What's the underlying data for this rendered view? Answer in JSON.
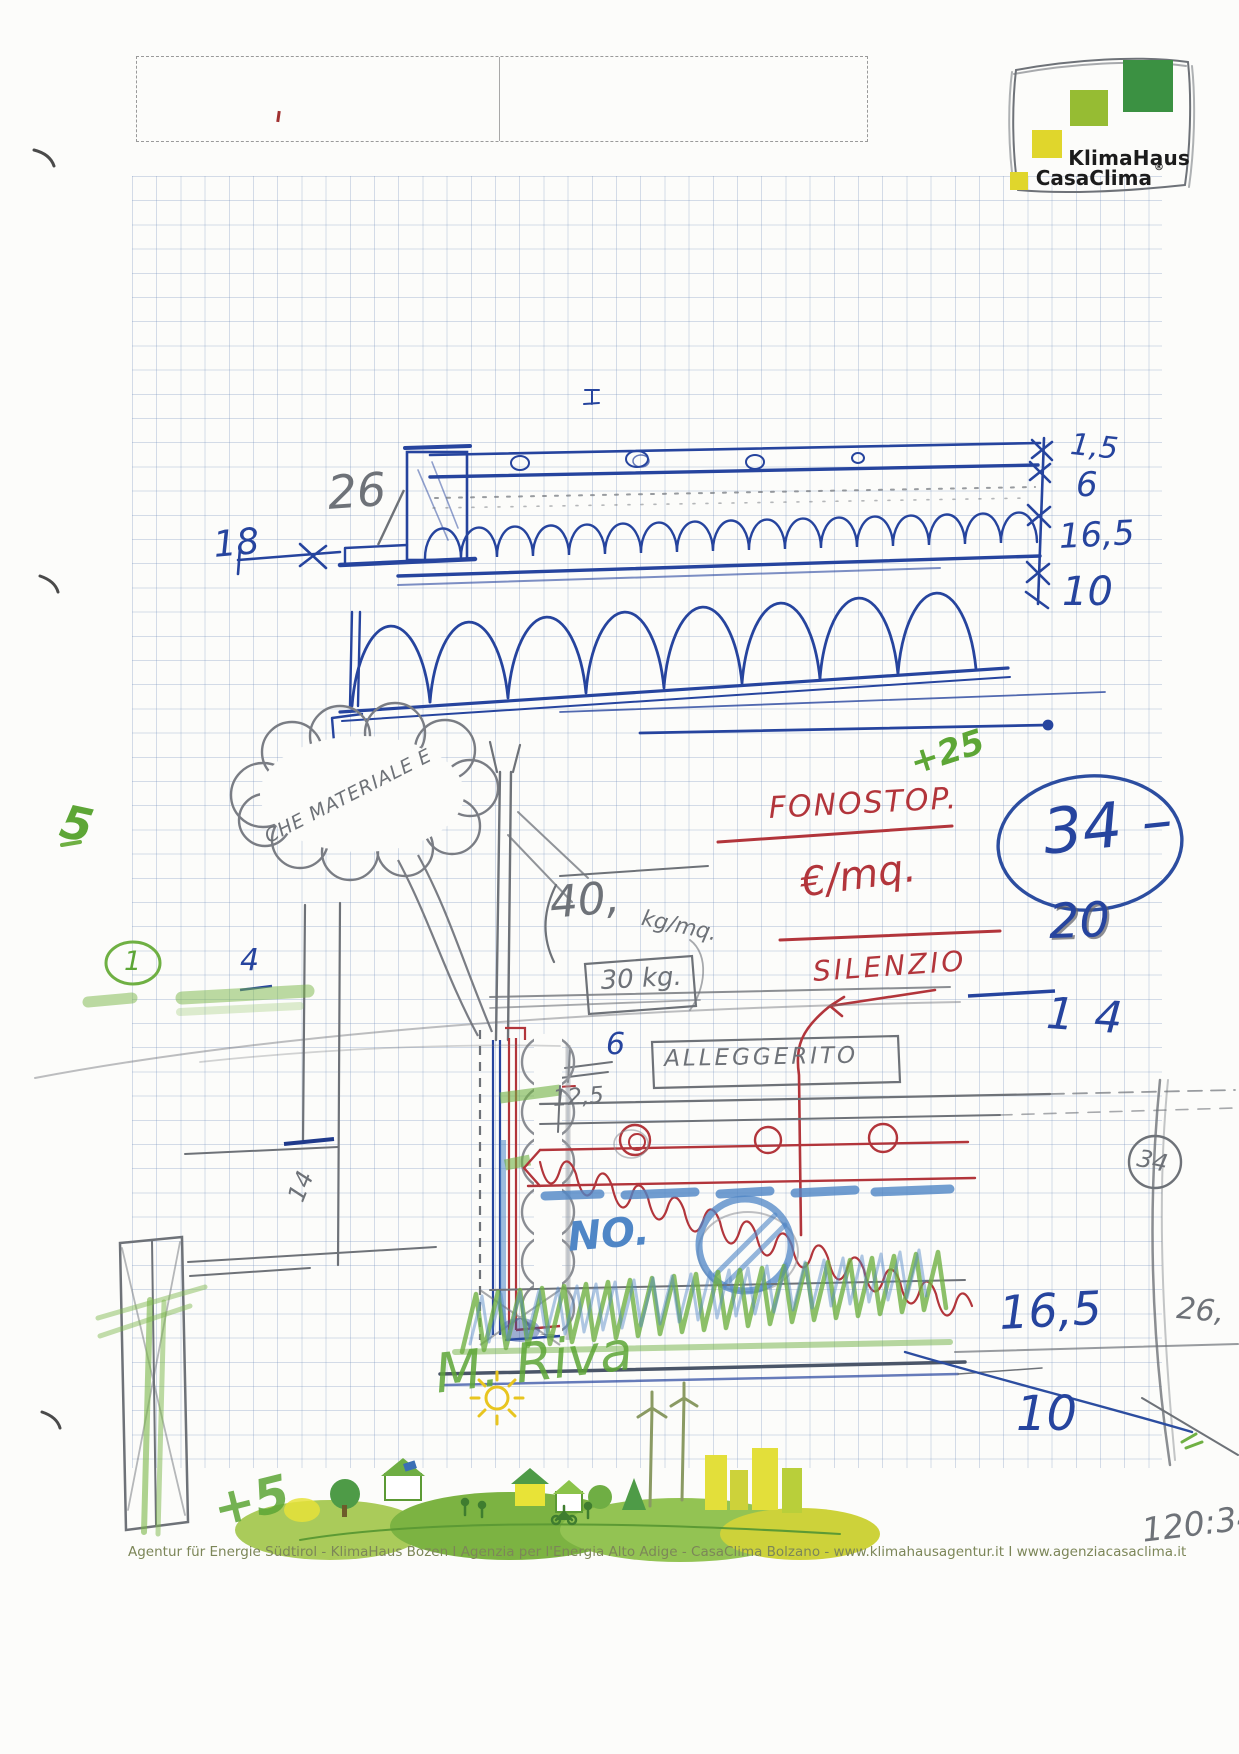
{
  "logo": {
    "name_line1": "KlimaHaus",
    "name_line2": "CasaClima",
    "registered_mark": "®"
  },
  "form": {
    "left_value": "",
    "right_value": ""
  },
  "annotations": {
    "dim_26": "26",
    "dim_18": "18",
    "dim_1_5": "1,5",
    "dim_6_top": "6",
    "dim_16_5_top": "16,5",
    "dim_10_top": "10",
    "cloud_question": "CHE MATERIALE È",
    "plus_25": "+25",
    "fonostop": "FONOSTOP.",
    "price_per_sqm": "€/mq.",
    "silenzio": "SILENZIO",
    "circled_total": "34 –",
    "num_20": "20",
    "num_14": "14",
    "weight_top": "40,",
    "weight_top_unit": "kg/mq.",
    "weight_box": "30 kg.",
    "dim_6_mid": "6",
    "dim_12_5": "12,5",
    "alleggerito": "ALLEGGERITO",
    "no_label": "NO.",
    "dim_16_5_low": "16,5",
    "dim_26_margin": "26,",
    "circled_margin_34": "34",
    "dim_10_low": "10",
    "circled_1": "1",
    "num_4_left": "4",
    "num_14_left": "14",
    "green_5": "5",
    "signature": "M. Riva",
    "plus_5": "+5",
    "calc_ratio": "120:34"
  },
  "footer": {
    "text": "Agentur für Energie Südtirol - KlimaHaus Bozen I Agenzia per l'Energia Alto Adige - CasaClima Bolzano - www.klimahausagentur.it I www.agenziacasaclima.it"
  },
  "colors": {
    "ink_blue": "#26449e",
    "pen_red": "#b2353b",
    "pencil_grey": "#6e7278",
    "crayon_green": "#5da636",
    "crayon_blue": "#4f86c6",
    "logo_dark_green": "#3b9142",
    "logo_light_green": "#96bc33",
    "logo_yellow": "#e0d62c"
  }
}
